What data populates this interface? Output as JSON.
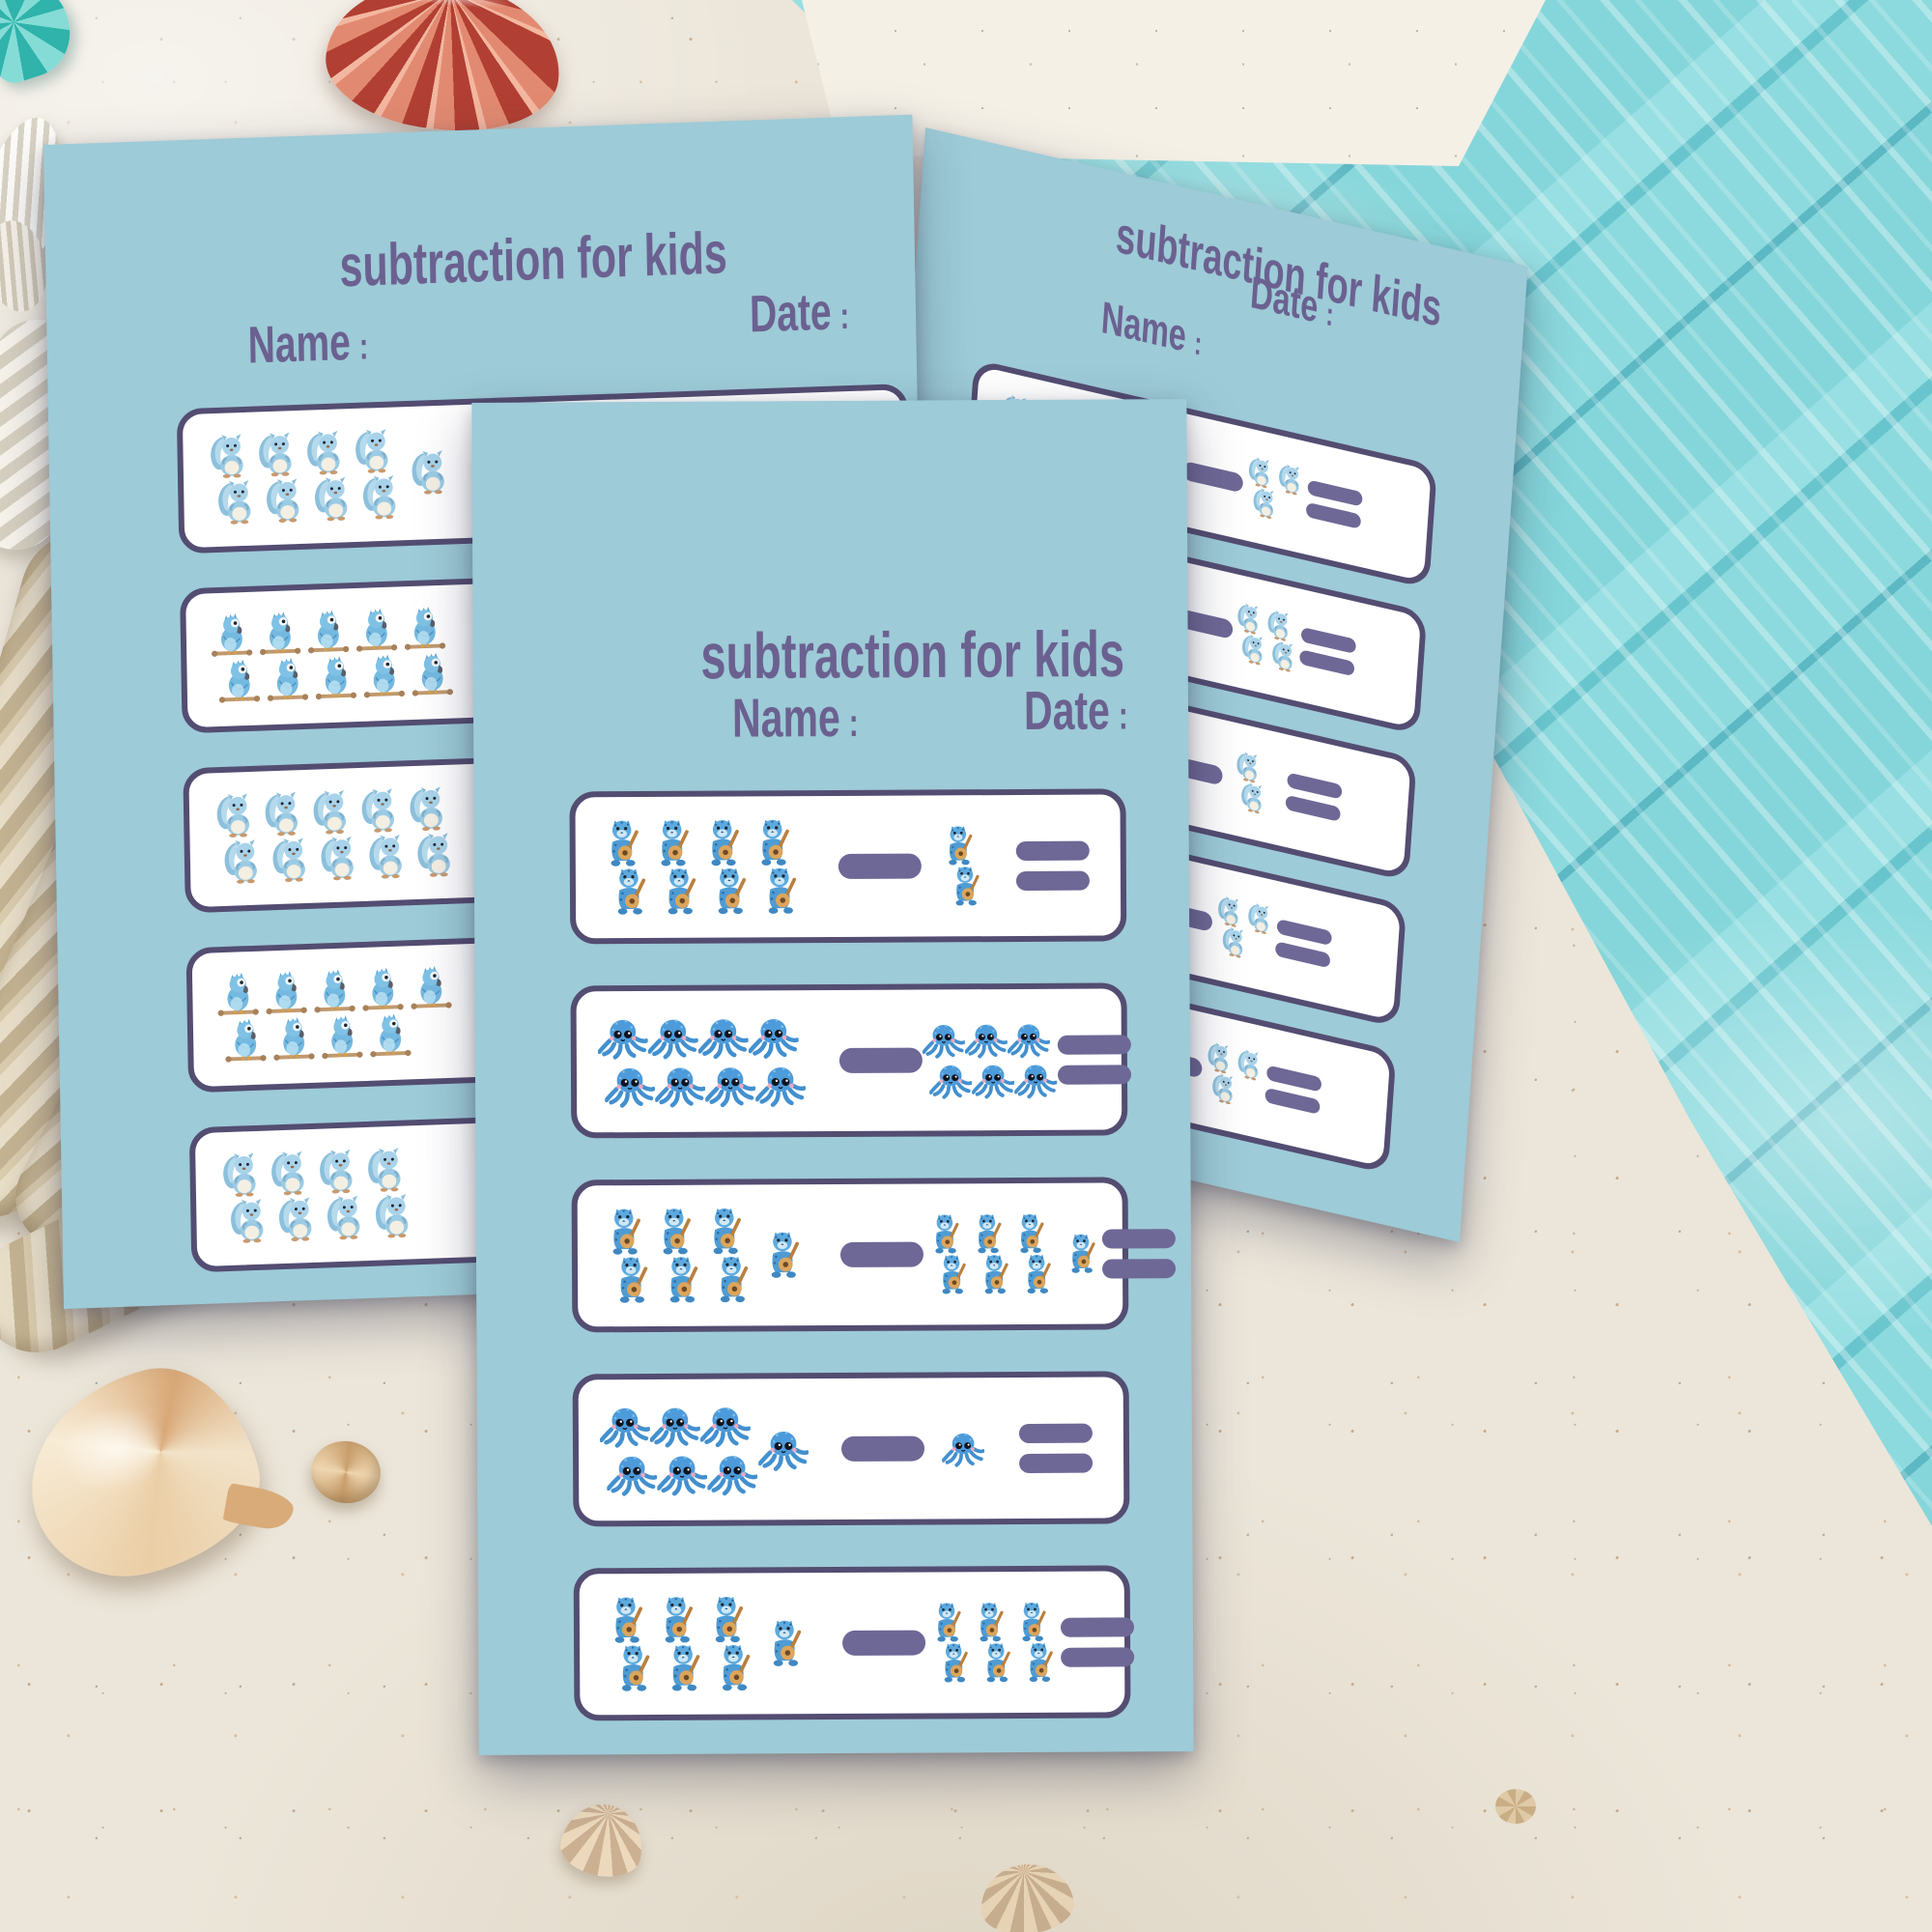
{
  "sheet": {
    "title": "subtraction for kids",
    "name_label": "Name",
    "date_label": "Date",
    "colon": ":"
  },
  "colors": {
    "page_background": "#9dcbd7",
    "heading_text": "#6b6190",
    "box_border": "#544d72",
    "operator_bars": "#6e6896",
    "box_fill": "#ffffff",
    "sand": "#ece6da",
    "planks": "#7ed2d8"
  },
  "worksheets": [
    {
      "id": "left",
      "problems": [
        {
          "animal": "squirrel",
          "minuend": {
            "value": 9,
            "rows": [
              4,
              4
            ],
            "side": 1
          },
          "subtrahend": {
            "value": 3,
            "rows": [
              2,
              1
            ],
            "side": 0
          }
        },
        {
          "animal": "bird",
          "minuend": {
            "value": 10,
            "rows": [
              5,
              5
            ],
            "side": 0
          },
          "subtrahend": {
            "value": 4,
            "rows": [
              2,
              2
            ],
            "side": 0
          }
        },
        {
          "animal": "squirrel",
          "minuend": {
            "value": 10,
            "rows": [
              5,
              5
            ],
            "side": 0
          },
          "subtrahend": {
            "value": 2,
            "rows": [
              1,
              1
            ],
            "side": 0
          }
        },
        {
          "animal": "bird",
          "minuend": {
            "value": 9,
            "rows": [
              5,
              4
            ],
            "side": 0
          },
          "subtrahend": {
            "value": 3,
            "rows": [
              2,
              1
            ],
            "side": 0
          }
        },
        {
          "animal": "squirrel",
          "minuend": {
            "value": 8,
            "rows": [
              4,
              4
            ],
            "side": 0
          },
          "subtrahend": {
            "value": 3,
            "rows": [
              2,
              1
            ],
            "side": 0
          }
        }
      ]
    },
    {
      "id": "right",
      "problems": [
        {
          "animal": "squirrel",
          "minuend": {
            "value": 9,
            "rows": [
              4,
              4
            ],
            "side": 1
          },
          "subtrahend": {
            "value": 3,
            "rows": [
              2,
              1
            ],
            "side": 0
          }
        },
        {
          "animal": "squirrel",
          "minuend": {
            "value": 10,
            "rows": [
              5,
              5
            ],
            "side": 0
          },
          "subtrahend": {
            "value": 4,
            "rows": [
              2,
              2
            ],
            "side": 0
          }
        },
        {
          "animal": "squirrel",
          "minuend": {
            "value": 10,
            "rows": [
              5,
              5
            ],
            "side": 0
          },
          "subtrahend": {
            "value": 2,
            "rows": [
              1,
              1
            ],
            "side": 0
          }
        },
        {
          "animal": "squirrel",
          "minuend": {
            "value": 9,
            "rows": [
              5,
              4
            ],
            "side": 0
          },
          "subtrahend": {
            "value": 3,
            "rows": [
              2,
              1
            ],
            "side": 0
          }
        },
        {
          "animal": "squirrel",
          "minuend": {
            "value": 8,
            "rows": [
              4,
              4
            ],
            "side": 0
          },
          "subtrahend": {
            "value": 3,
            "rows": [
              2,
              1
            ],
            "side": 0
          }
        }
      ]
    },
    {
      "id": "center",
      "problems": [
        {
          "animal": "cat",
          "minuend": {
            "value": 8,
            "rows": [
              4,
              4
            ],
            "side": 0
          },
          "subtrahend": {
            "value": 2,
            "rows": [
              1,
              1
            ],
            "side": 0
          }
        },
        {
          "animal": "octopus",
          "minuend": {
            "value": 8,
            "rows": [
              4,
              4
            ],
            "side": 0
          },
          "subtrahend": {
            "value": 6,
            "rows": [
              3,
              3
            ],
            "side": 0
          }
        },
        {
          "animal": "cat",
          "minuend": {
            "value": 7,
            "rows": [
              3,
              3
            ],
            "side": 1
          },
          "subtrahend": {
            "value": 7,
            "rows": [
              3,
              3
            ],
            "side": 1
          }
        },
        {
          "animal": "octopus",
          "minuend": {
            "value": 7,
            "rows": [
              3,
              3
            ],
            "side": 1
          },
          "subtrahend": {
            "value": 1,
            "rows": [
              1
            ],
            "side": 0
          }
        },
        {
          "animal": "cat",
          "minuend": {
            "value": 7,
            "rows": [
              3,
              3
            ],
            "side": 1
          },
          "subtrahend": {
            "value": 6,
            "rows": [
              3,
              3
            ],
            "side": 0
          }
        }
      ]
    }
  ],
  "decor": {
    "surface": "sand-beach-with-turquoise-wood-planks",
    "elements": [
      "turquoise-wood-planks",
      "white-painted-board",
      "scallop-shell",
      "clam-shell",
      "spiral-shell",
      "rope-coil",
      "rope-strand",
      "conch-shell",
      "snail-shell",
      "fan-shell",
      "tiny-shell"
    ]
  }
}
